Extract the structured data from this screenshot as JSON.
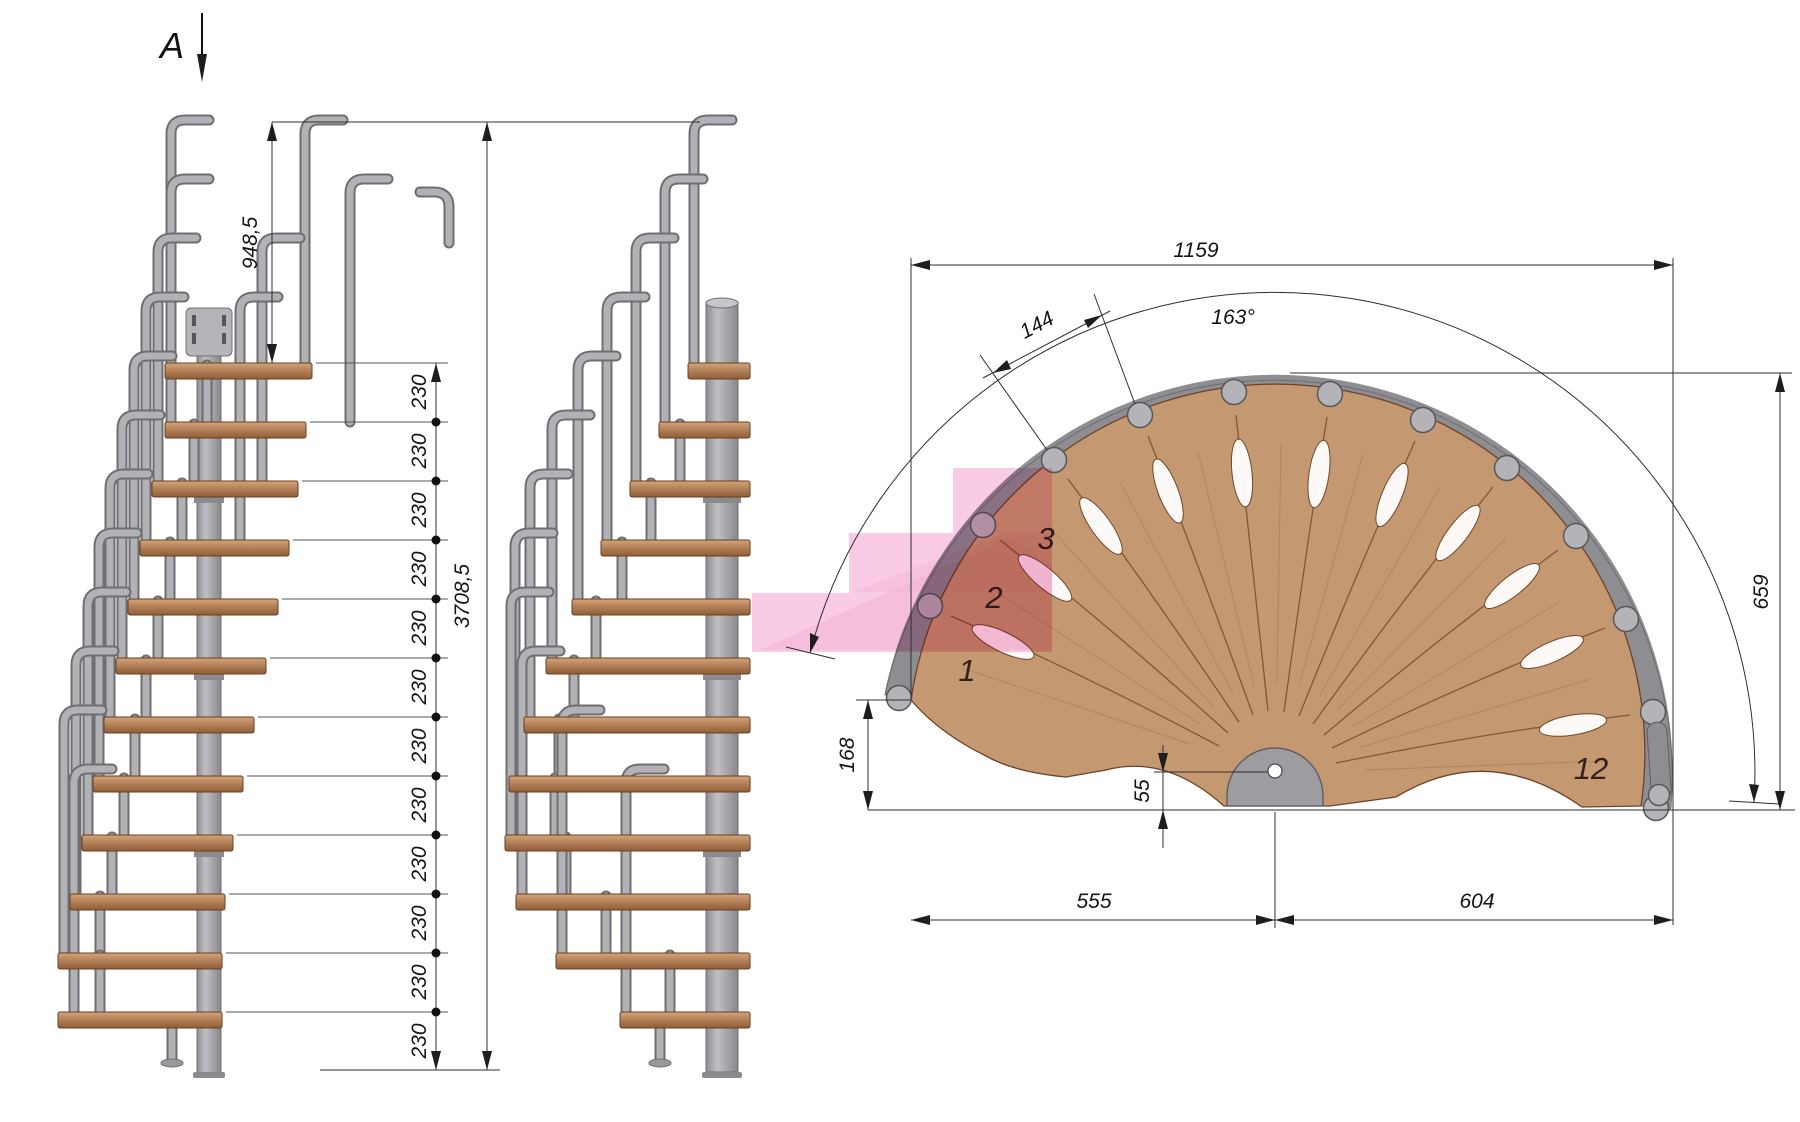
{
  "section": {
    "label": "A"
  },
  "side_view": {
    "handrail_height": "948,5",
    "total_height": "3708,5",
    "riser": "230"
  },
  "plan_view": {
    "overall_width": "1159",
    "sweep_angle": "163°",
    "step_width": "144",
    "depth": "659",
    "tip_offset": "168",
    "pole_offset": "55",
    "span_left": "555",
    "span_right": "604",
    "steps": {
      "first": "1",
      "second": "2",
      "third": "3",
      "last": "12"
    }
  },
  "colors": {
    "wood": "#c49871",
    "tread": "#b07c50",
    "steel": "#a9a9ad",
    "highlight_pink": "#f8bedd",
    "dimension_lines": "#2f2f2f"
  }
}
